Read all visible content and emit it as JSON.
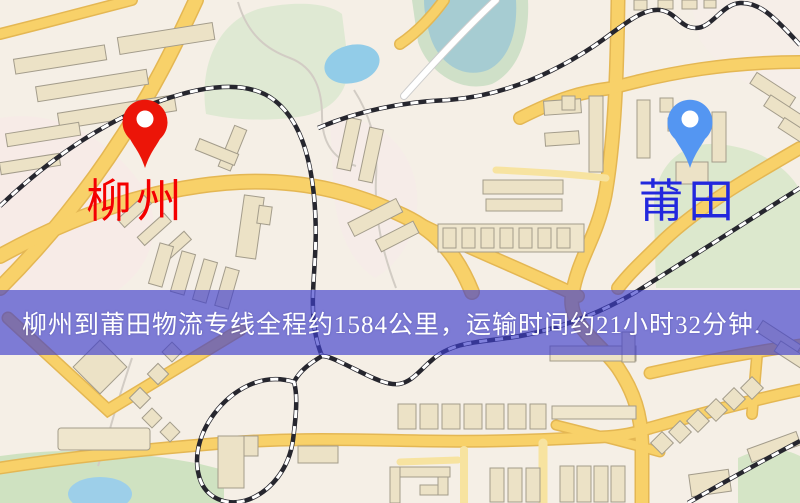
{
  "map": {
    "banner": {
      "text": "柳州到莆田物流专线全程约1584公里，运输时间约21小时32分钟.",
      "background_color": "#3e3ecc",
      "text_color": "#ffffff"
    },
    "origin": {
      "label": "柳州",
      "marker": "map-pin",
      "marker_color": "#ec1508",
      "label_color": "#f40000"
    },
    "destination": {
      "label": "莆田",
      "marker": "map-pin",
      "marker_color": "#5496f2",
      "label_color": "#2228dd"
    },
    "palette": {
      "map_background": "#f5efe6",
      "road_fill": "#f8d169",
      "road_casing": "#e4b753",
      "building_fill": "#ece2c6",
      "building_stroke": "#a39c8b",
      "park_green": "#dde9d1",
      "water_blue": "#9dcfe9",
      "railway_dark": "#26262e"
    }
  }
}
